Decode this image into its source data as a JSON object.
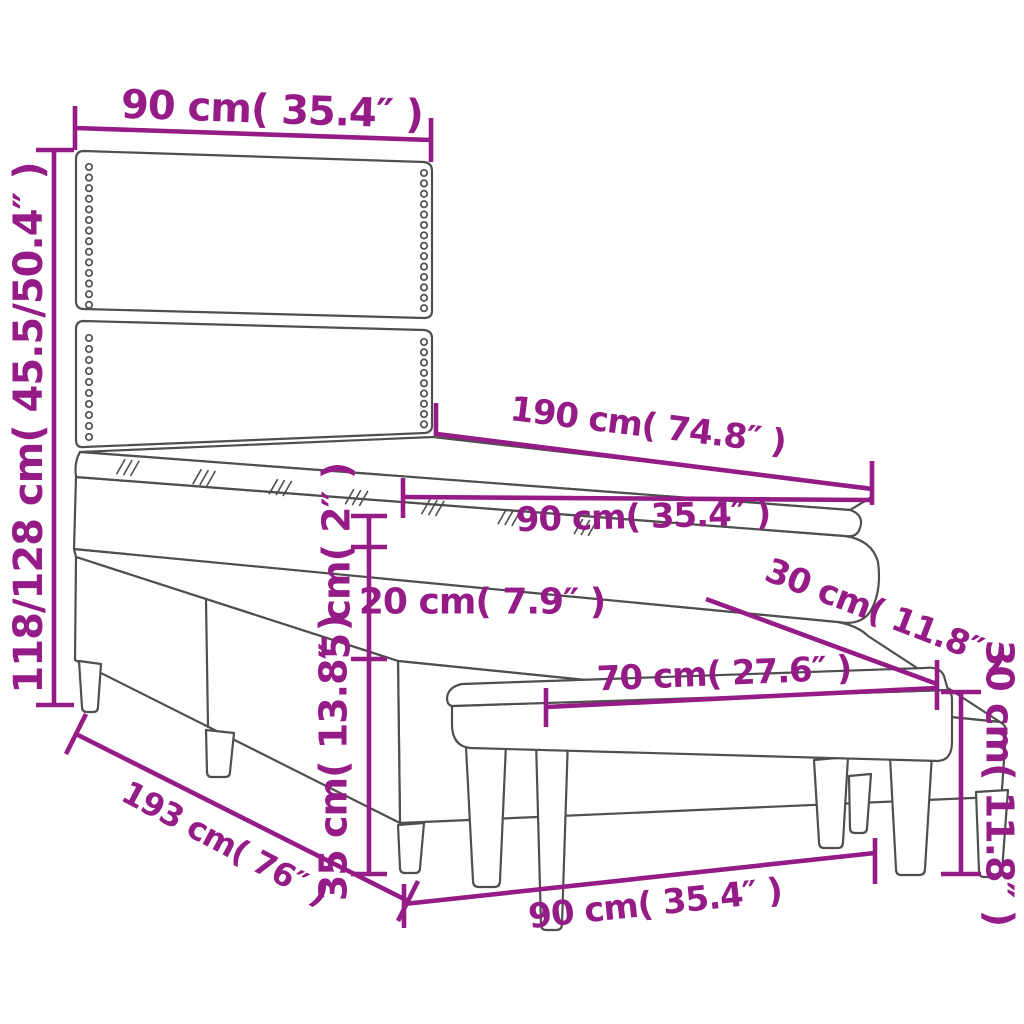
{
  "diagram": {
    "kind": "furniture-dimension-diagram",
    "subject": "box spring bed with headboard, mattress topper and bench",
    "accent_color": "#951c86",
    "line_color": "#4f4f4f",
    "background_color": "#ffffff",
    "measurements": {
      "headboard_width": {
        "label": "90 cm( 35.4″ )",
        "cm": "90",
        "inch": "35.4"
      },
      "overall_height": {
        "label": "118/128 cm( 45.5/50.4″ )",
        "cm": "118/128",
        "inch": "45.5/50.4"
      },
      "mattress_length": {
        "label": "190 cm( 74.8″ )",
        "cm": "190",
        "inch": "74.8"
      },
      "mattress_width": {
        "label": "90 cm( 35.4″ )",
        "cm": "90",
        "inch": "35.4"
      },
      "topper_thickness": {
        "label": "5 cm( 2″ )",
        "cm": "5",
        "inch": "2"
      },
      "mattress_thickness": {
        "label": "20 cm( 7.9″ )",
        "cm": "20",
        "inch": "7.9"
      },
      "base_height": {
        "label": "35 cm( 13.8″ )",
        "cm": "35",
        "inch": "13.8"
      },
      "bed_length": {
        "label": "193 cm( 76″ )",
        "cm": "193",
        "inch": "76"
      },
      "bed_width": {
        "label": "90 cm( 35.4″ )",
        "cm": "90",
        "inch": "35.4"
      },
      "bench_depth": {
        "label": "30 cm( 11.8″ )",
        "cm": "30",
        "inch": "11.8"
      },
      "bench_length": {
        "label": "70 cm( 27.6″ )",
        "cm": "70",
        "inch": "27.6"
      },
      "bench_height": {
        "label": "30 cm( 11.8″ )",
        "cm": "30",
        "inch": "11.8"
      }
    }
  }
}
